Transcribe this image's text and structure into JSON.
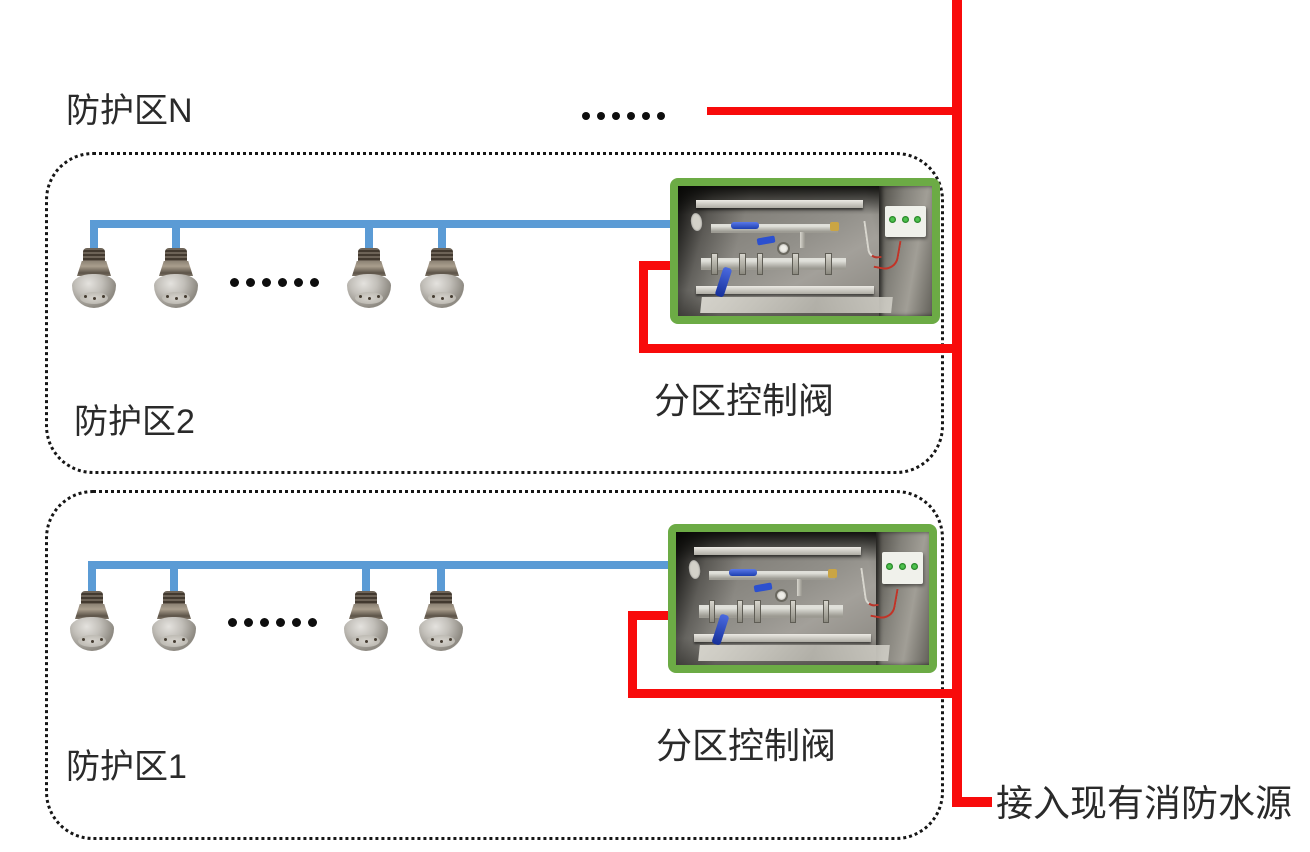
{
  "diagram": {
    "top_zone": {
      "label": "防护区N",
      "ellipsis": "……"
    },
    "zones": [
      {
        "label": "防护区2",
        "valve_label": "分区控制阀",
        "ellipsis": "……"
      },
      {
        "label": "防护区1",
        "valve_label": "分区控制阀",
        "ellipsis": "……"
      }
    ],
    "water_source_label": "接入现有消防水源",
    "colors": {
      "nozzle_pipe_blue": "#5b9bd5",
      "supply_pipe_red": "#f80b0b",
      "valve_frame_green": "#6cab45",
      "zone_border_black": "#161616"
    }
  }
}
